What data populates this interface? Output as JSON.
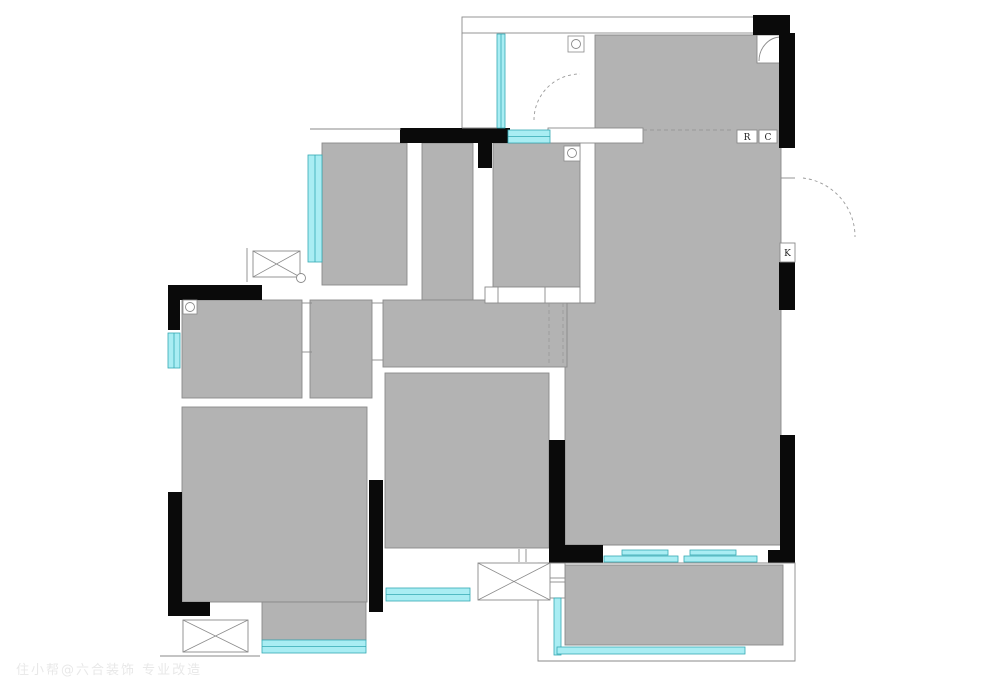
{
  "plan": {
    "canvas": {
      "width": 1000,
      "height": 699
    },
    "colors": {
      "white": "#ffffff",
      "room": "#b3b3b3",
      "line": "#8a8a8a",
      "wall": "#0a0a0a",
      "window": "#a9edf3",
      "window_edge": "#35a9b3",
      "dash": "#9a9a9a",
      "text": "#222222"
    },
    "labels": {
      "refrigerator_tag": "R",
      "cabinet_tag": "C",
      "door_tag": "K"
    },
    "watermark": {
      "text": "住小帮@六合装饰 专业改造"
    },
    "shapes": [
      {
        "t": "rect",
        "n": "balcony-top-strip",
        "r": [
          462,
          17,
          293,
          16
        ],
        "fill": "white",
        "stroke": 1
      },
      {
        "t": "path",
        "n": "living-dining-room",
        "d": "M595,35H781V545H565V303H595Z",
        "fill": "room",
        "stroke": 1
      },
      {
        "t": "rect",
        "n": "hall-vertical",
        "r": [
          422,
          143,
          51,
          157
        ],
        "fill": "room",
        "stroke": 1
      },
      {
        "t": "rect",
        "n": "hall-horizontal",
        "r": [
          383,
          300,
          184,
          67
        ],
        "fill": "room",
        "stroke": 1
      },
      {
        "t": "rect",
        "n": "room-top-left",
        "r": [
          322,
          143,
          85,
          142
        ],
        "fill": "room",
        "stroke": 1
      },
      {
        "t": "rect",
        "n": "room-top-middle",
        "r": [
          493,
          143,
          87,
          144
        ],
        "fill": "room",
        "stroke": 1
      },
      {
        "t": "rect",
        "n": "alcove",
        "r": [
          310,
          300,
          62,
          98
        ],
        "fill": "room",
        "stroke": 1
      },
      {
        "t": "rect",
        "n": "bathroom",
        "r": [
          182,
          300,
          120,
          98
        ],
        "fill": "room",
        "stroke": 1
      },
      {
        "t": "rect",
        "n": "bedroom-left",
        "r": [
          182,
          407,
          185,
          195
        ],
        "fill": "room",
        "stroke": 1
      },
      {
        "t": "rect",
        "n": "bedroom-left-extension",
        "r": [
          262,
          602,
          104,
          38
        ],
        "fill": "room",
        "stroke": 1
      },
      {
        "t": "rect",
        "n": "bedroom-middle",
        "r": [
          385,
          373,
          164,
          175
        ],
        "fill": "room",
        "stroke": 1
      },
      {
        "t": "rect",
        "n": "balcony",
        "r": [
          565,
          565,
          218,
          80
        ],
        "fill": "room",
        "stroke": 1
      },
      {
        "t": "rect",
        "n": "living-top-divider",
        "r": [
          548,
          128,
          95,
          15
        ],
        "fill": "white",
        "stroke": 1
      },
      {
        "t": "rect",
        "n": "corner-fixture",
        "r": [
          757,
          35,
          26,
          28
        ],
        "fill": "white",
        "stroke": 1
      },
      {
        "t": "path",
        "n": "corner-fixture-arc",
        "d": "M759,61A22,24 0 0 1 781,37",
        "stroke": 1
      },
      {
        "t": "rect",
        "n": "closet",
        "r": [
          485,
          287,
          95,
          16
        ],
        "fill": "white",
        "stroke": 1
      },
      {
        "t": "line",
        "n": "closet-divider-1",
        "p": [
          498,
          287,
          498,
          303
        ]
      },
      {
        "t": "line",
        "n": "closet-divider-2",
        "p": [
          545,
          287,
          545,
          303
        ]
      },
      {
        "t": "rect",
        "n": "balcony-step-1",
        "r": [
          540,
          563,
          25,
          15
        ],
        "fill": "white",
        "stroke": 1
      },
      {
        "t": "rect",
        "n": "balcony-step-2",
        "r": [
          540,
          582,
          25,
          16
        ],
        "fill": "white",
        "stroke": 1
      },
      {
        "t": "wall",
        "n": "wall-top-right-block",
        "r": [
          753,
          15,
          37,
          20
        ]
      },
      {
        "t": "wall",
        "n": "wall-right-upper",
        "r": [
          779,
          33,
          16,
          115
        ]
      },
      {
        "t": "wall",
        "n": "wall-right-mid",
        "r": [
          779,
          262,
          16,
          48
        ]
      },
      {
        "t": "wall",
        "n": "wall-right-lower",
        "r": [
          780,
          435,
          15,
          128
        ]
      },
      {
        "t": "wall",
        "n": "wall-living-bottom-right",
        "r": [
          768,
          550,
          27,
          13
        ]
      },
      {
        "t": "wall",
        "n": "wall-living-bottom-left",
        "r": [
          549,
          545,
          54,
          18
        ]
      },
      {
        "t": "wall",
        "n": "wall-bedroom-middle-right",
        "r": [
          549,
          440,
          16,
          105
        ]
      },
      {
        "t": "wall",
        "n": "wall-top-middle",
        "r": [
          400,
          128,
          110,
          15
        ]
      },
      {
        "t": "wall",
        "n": "wall-top-middle-stub",
        "r": [
          478,
          143,
          14,
          25
        ]
      },
      {
        "t": "wall",
        "n": "wall-bathroom-top",
        "r": [
          168,
          285,
          94,
          15
        ]
      },
      {
        "t": "wall",
        "n": "wall-left-upper-stub",
        "r": [
          168,
          285,
          12,
          45
        ]
      },
      {
        "t": "wall",
        "n": "wall-left-lower",
        "r": [
          168,
          492,
          14,
          124
        ]
      },
      {
        "t": "wall",
        "n": "wall-bottom-left",
        "r": [
          168,
          602,
          42,
          14
        ]
      },
      {
        "t": "wall",
        "n": "wall-bedroom-left-right",
        "r": [
          369,
          480,
          14,
          132
        ]
      },
      {
        "t": "window",
        "n": "window-entry",
        "r": [
          497,
          34,
          8,
          94
        ]
      },
      {
        "t": "window",
        "n": "window-room-top-middle",
        "r": [
          508,
          130,
          42,
          13
        ]
      },
      {
        "t": "window",
        "n": "window-room-top-left",
        "r": [
          308,
          155,
          14,
          107
        ]
      },
      {
        "t": "window",
        "n": "window-bathroom",
        "r": [
          168,
          333,
          12,
          35
        ]
      },
      {
        "t": "window",
        "n": "window-bedroom-left",
        "r": [
          262,
          640,
          104,
          13
        ]
      },
      {
        "t": "window",
        "n": "window-bedroom-middle",
        "r": [
          386,
          588,
          84,
          13
        ]
      },
      {
        "t": "window",
        "n": "sliding-door-panel-1",
        "r": [
          622,
          550,
          46,
          5
        ]
      },
      {
        "t": "window",
        "n": "sliding-door-panel-2",
        "r": [
          690,
          550,
          46,
          5
        ]
      },
      {
        "t": "window",
        "n": "sliding-door-panel-3",
        "r": [
          604,
          556,
          74,
          6
        ]
      },
      {
        "t": "window",
        "n": "sliding-door-panel-4",
        "r": [
          684,
          556,
          73,
          6
        ]
      },
      {
        "t": "window",
        "n": "window-balcony-left",
        "r": [
          554,
          598,
          7,
          57
        ]
      },
      {
        "t": "window",
        "n": "window-balcony-bottom",
        "r": [
          557,
          647,
          188,
          7
        ]
      },
      {
        "t": "path",
        "n": "balcony-outline",
        "d": "M538,563H795V661H538Z",
        "stroke": 1
      },
      {
        "t": "cross",
        "n": "fixture-box-top-left",
        "r": [
          253,
          251,
          47,
          26
        ]
      },
      {
        "t": "cross",
        "n": "fixture-box-bottom-left",
        "r": [
          183,
          620,
          65,
          32
        ]
      },
      {
        "t": "cross",
        "n": "fixture-box-bottom-middle",
        "r": [
          478,
          563,
          72,
          37
        ]
      },
      {
        "t": "line",
        "n": "outer-line-top-left-room",
        "p": [
          310,
          129,
          401,
          129
        ]
      },
      {
        "t": "line",
        "n": "entry-left-edge",
        "p": [
          462,
          33,
          462,
          128
        ]
      },
      {
        "t": "line",
        "n": "entry-bottom-edge",
        "p": [
          462,
          128,
          497,
          128
        ]
      },
      {
        "t": "line",
        "n": "ledge-line-bottom-left",
        "p": [
          160,
          656,
          260,
          656
        ]
      },
      {
        "t": "line",
        "n": "fixture-line-top-left",
        "p": [
          247,
          248,
          247,
          282
        ]
      },
      {
        "t": "line",
        "n": "door-jamb-right",
        "p": [
          781,
          178,
          795,
          178
        ]
      },
      {
        "t": "line",
        "n": "bathroom-door-jamb-1",
        "p": [
          302,
          303,
          312,
          303
        ]
      },
      {
        "t": "line",
        "n": "bathroom-door-jamb-2",
        "p": [
          302,
          352,
          312,
          352
        ]
      },
      {
        "t": "line",
        "n": "alcove-door-jamb-1",
        "p": [
          372,
          303,
          383,
          303
        ]
      },
      {
        "t": "line",
        "n": "alcove-door-jamb-2",
        "p": [
          372,
          360,
          383,
          360
        ]
      },
      {
        "t": "line",
        "n": "bedroom-middle-jamb-1",
        "p": [
          519,
          549,
          519,
          562
        ]
      },
      {
        "t": "line",
        "n": "bedroom-middle-jamb-2",
        "p": [
          526,
          549,
          526,
          562
        ]
      },
      {
        "t": "dline",
        "n": "beam-dashed-living-top",
        "p": [
          643,
          130,
          734,
          130
        ]
      },
      {
        "t": "dline",
        "n": "beam-dashed-hall-1",
        "p": [
          549,
          303,
          549,
          365
        ]
      },
      {
        "t": "dline",
        "n": "beam-dashed-hall-2",
        "p": [
          563,
          303,
          563,
          365
        ]
      },
      {
        "t": "dpath",
        "n": "entry-door-arc",
        "d": "M534,120A46,46 0 0 1 580,74"
      },
      {
        "t": "dpath",
        "n": "side-door-arc",
        "d": "M803,178A59,59 0 0 1 855,237"
      },
      {
        "t": "hinge",
        "n": "door-hinge-entry",
        "c": [
          576,
          44
        ],
        "sq": [
          568,
          36,
          16,
          16
        ]
      },
      {
        "t": "hinge",
        "n": "door-hinge-room-top-middle",
        "c": [
          572,
          153
        ],
        "sq": [
          564,
          146,
          16,
          15
        ]
      },
      {
        "t": "hinge",
        "n": "door-hinge-bathroom",
        "c": [
          190,
          307
        ],
        "sq": [
          183,
          300,
          14,
          14
        ]
      },
      {
        "t": "hinge",
        "n": "door-hinge-fixture",
        "c": [
          301,
          278
        ]
      },
      {
        "t": "tag",
        "n": "label-refrigerator",
        "r": [
          737,
          130,
          20,
          13
        ],
        "key": "refrigerator_tag"
      },
      {
        "t": "tag",
        "n": "label-cabinet",
        "r": [
          759,
          130,
          18,
          13
        ],
        "key": "cabinet_tag"
      },
      {
        "t": "tag",
        "n": "label-door",
        "r": [
          780,
          243,
          15,
          19
        ],
        "key": "door_tag"
      }
    ]
  }
}
